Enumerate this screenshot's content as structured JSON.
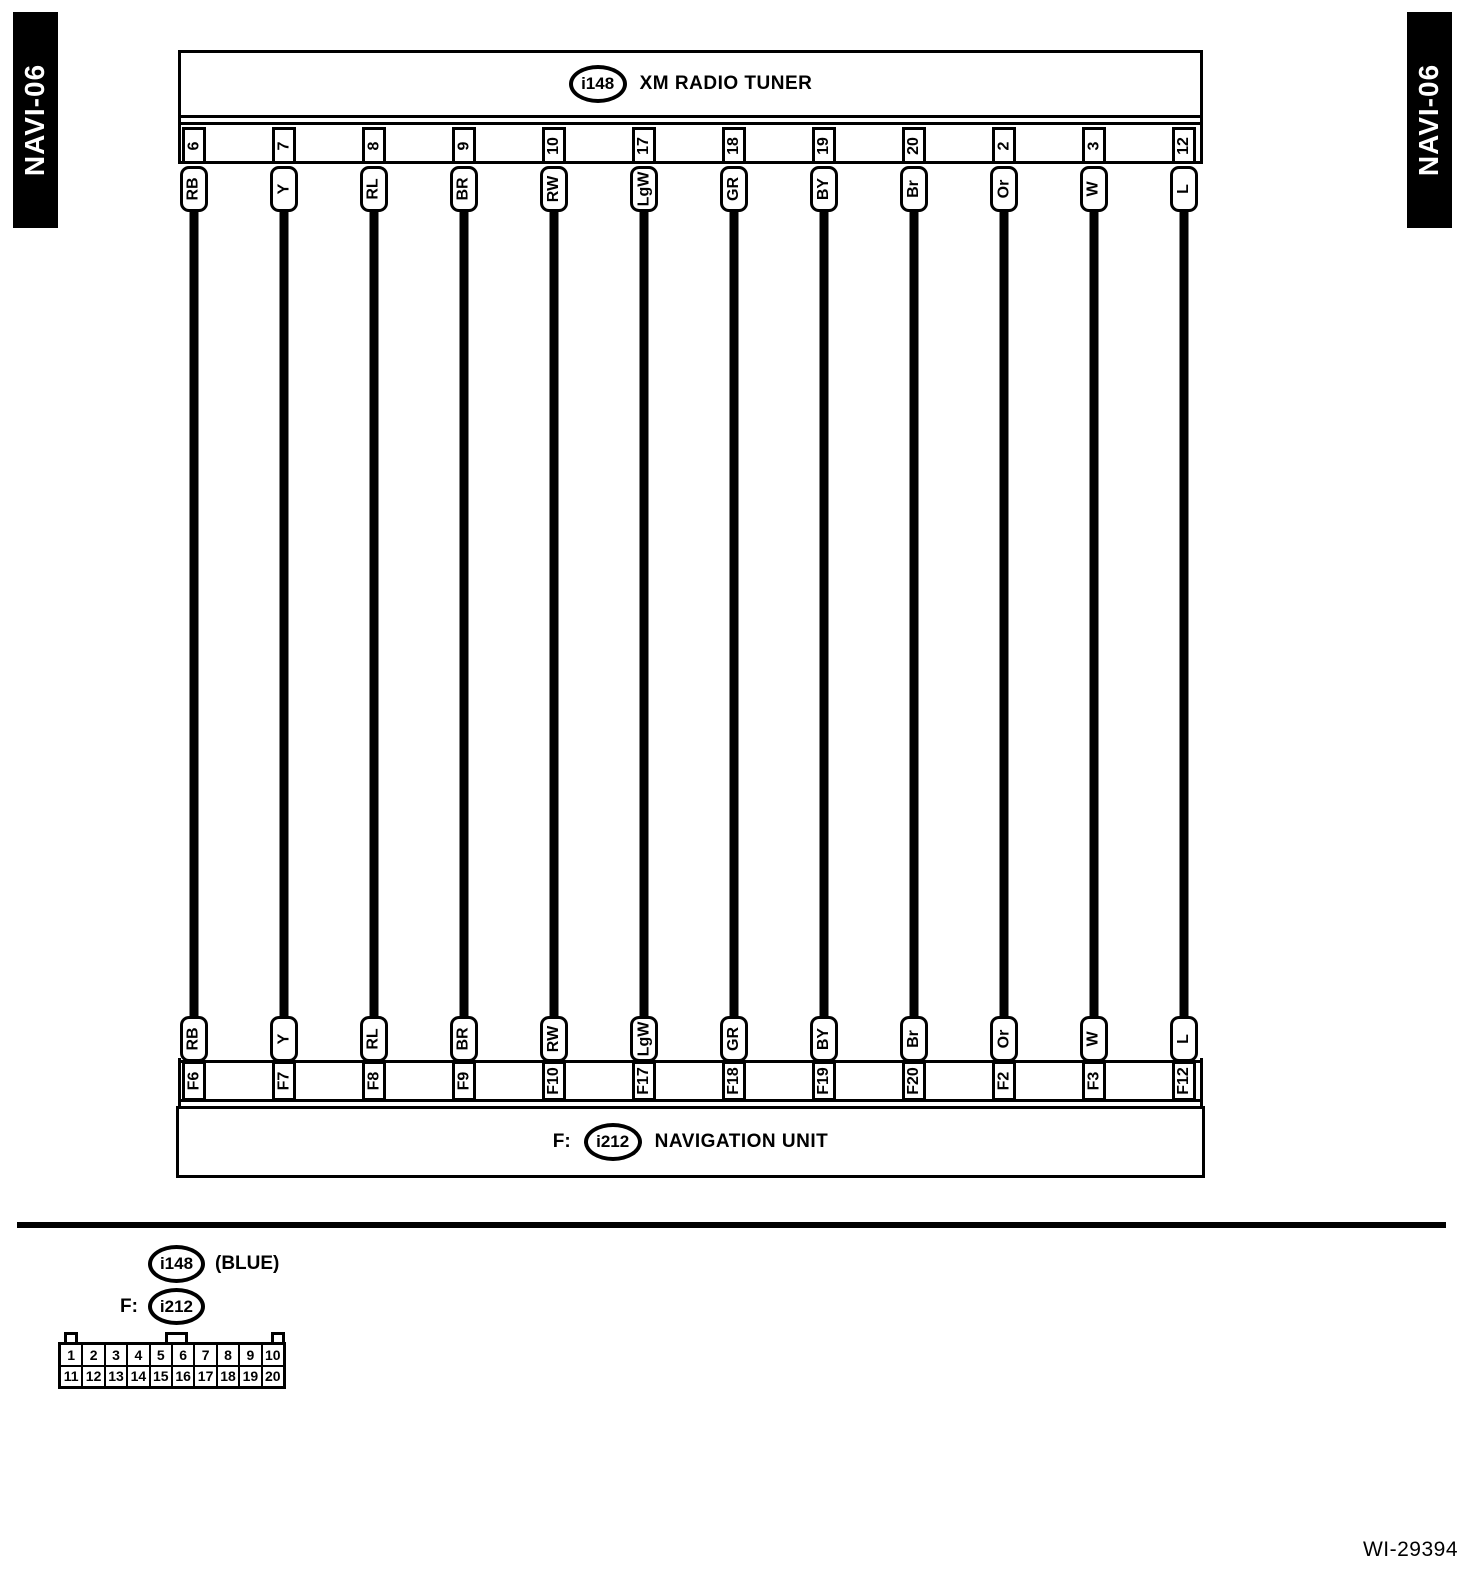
{
  "page": {
    "left_tab": "NAVI-06",
    "right_tab": "NAVI-06",
    "doc_ref": "WI-29394",
    "colors": {
      "ink": "#000000",
      "paper": "#ffffff"
    }
  },
  "top_component": {
    "connector_id": "i148",
    "label": "XM RADIO TUNER"
  },
  "bottom_component": {
    "prefix": "F:",
    "connector_id": "i212",
    "label": "NAVIGATION UNIT"
  },
  "wires": [
    {
      "top_pin": "6",
      "color": "RB",
      "bottom_pin": "F6"
    },
    {
      "top_pin": "7",
      "color": "Y",
      "bottom_pin": "F7"
    },
    {
      "top_pin": "8",
      "color": "RL",
      "bottom_pin": "F8"
    },
    {
      "top_pin": "9",
      "color": "BR",
      "bottom_pin": "F9"
    },
    {
      "top_pin": "10",
      "color": "RW",
      "bottom_pin": "F10"
    },
    {
      "top_pin": "17",
      "color": "LgW",
      "bottom_pin": "F17"
    },
    {
      "top_pin": "18",
      "color": "GR",
      "bottom_pin": "F18"
    },
    {
      "top_pin": "19",
      "color": "BY",
      "bottom_pin": "F19"
    },
    {
      "top_pin": "20",
      "color": "Br",
      "bottom_pin": "F20"
    },
    {
      "top_pin": "2",
      "color": "Or",
      "bottom_pin": "F2"
    },
    {
      "top_pin": "3",
      "color": "W",
      "bottom_pin": "F3"
    },
    {
      "top_pin": "12",
      "color": "L",
      "bottom_pin": "F12"
    }
  ],
  "legend": {
    "connector_148": {
      "id": "i148",
      "note": "(BLUE)"
    },
    "connector_212": {
      "prefix": "F:",
      "id": "i212"
    },
    "pin_grid": {
      "rows": [
        [
          "1",
          "2",
          "3",
          "4",
          "5",
          "6",
          "7",
          "8",
          "9",
          "10"
        ],
        [
          "11",
          "12",
          "13",
          "14",
          "15",
          "16",
          "17",
          "18",
          "19",
          "20"
        ]
      ]
    }
  }
}
